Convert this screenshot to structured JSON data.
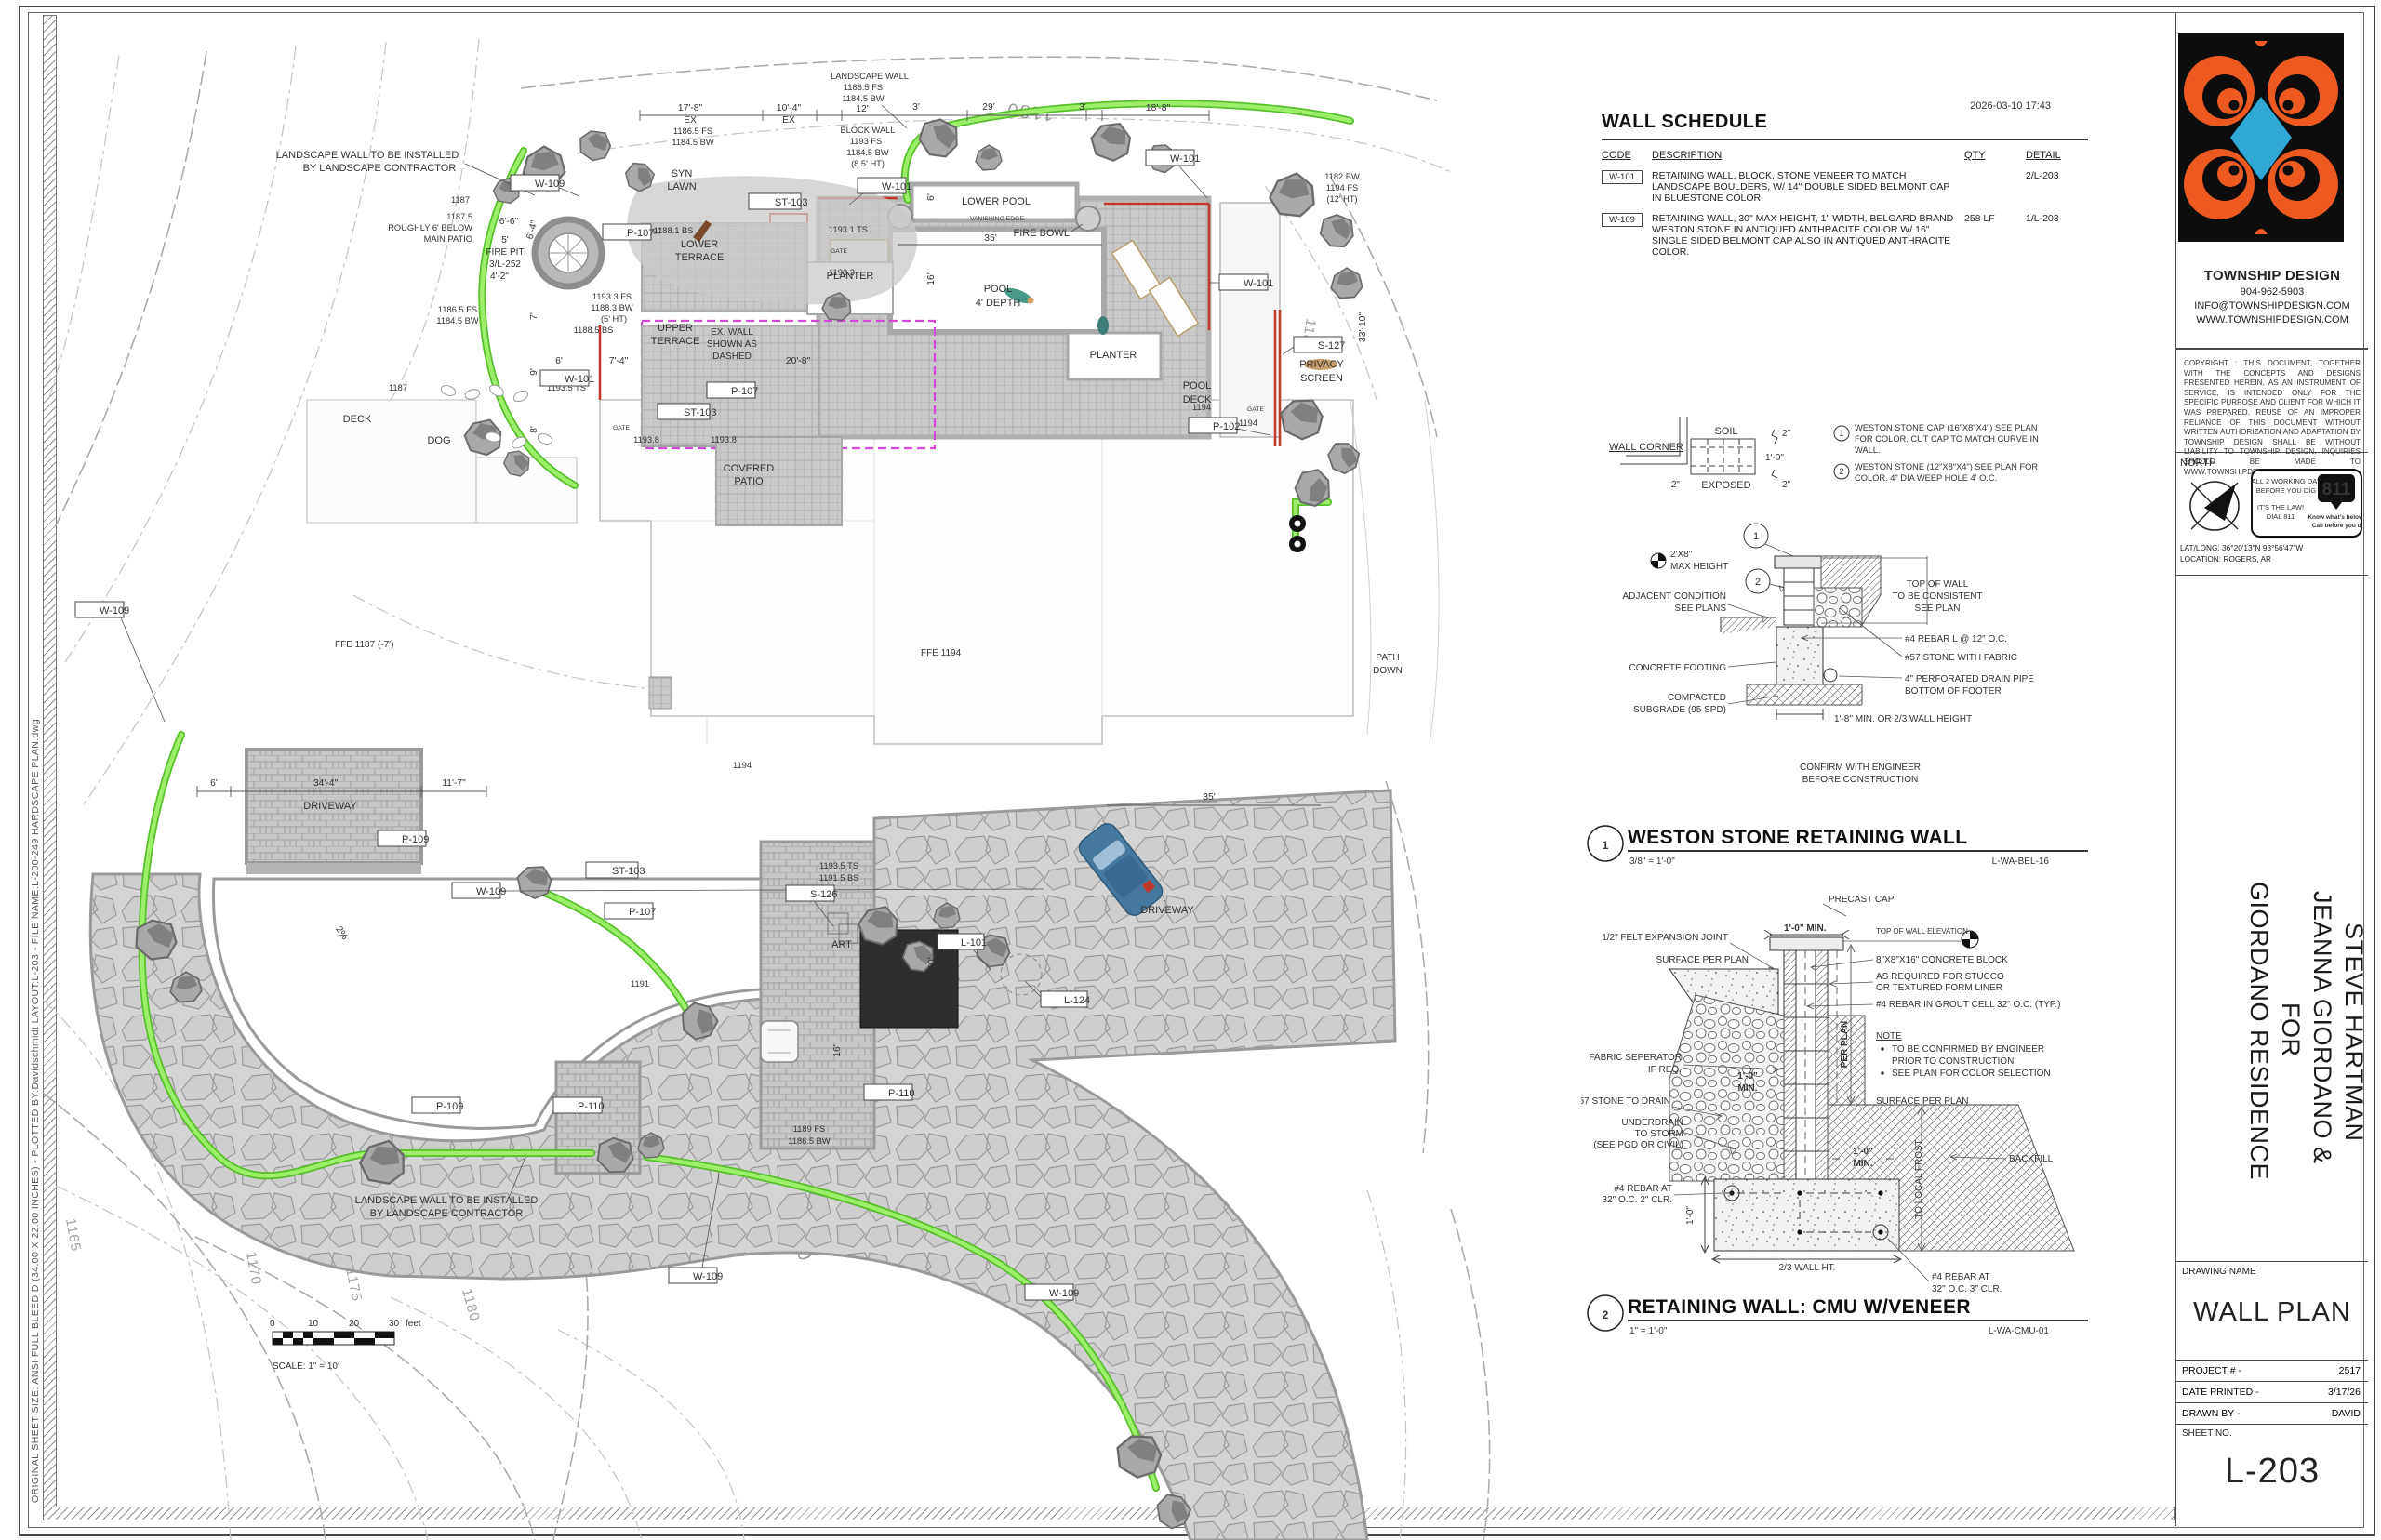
{
  "sheet": {
    "timestamp": "2026-03-10 17:43",
    "edge_text": "ORIGINAL SHEET SIZE: ANSI FULL BLEED D (34.00 X 22.00 INCHES) - PLOTTED BY:Davidschmidt  LAYOUT:L-203 - FILE NAME:L-200-249 HARDSCAPE PLAN.dwg"
  },
  "schedule": {
    "title": "WALL SCHEDULE",
    "col_code": "CODE",
    "col_desc": "DESCRIPTION",
    "col_qty": "QTY",
    "col_detail": "DETAIL",
    "rows": [
      {
        "code": "W-101",
        "desc": "RETAINING WALL, BLOCK, STONE VENEER TO MATCH LANDSCAPE BOULDERS, W/ 14\" DOUBLE SIDED  BELMONT CAP IN BLUESTONE COLOR.",
        "qty": "",
        "detail": "2/L-203"
      },
      {
        "code": "W-109",
        "desc": "RETAINING WALL, 30\" MAX HEIGHT, 1\" WIDTH, BELGARD BRAND WESTON STONE IN ANTIQUED ANTHRACITE COLOR W/ 16\" SINGLE SIDED BELMONT CAP ALSO IN ANTIQUED ANTHRACITE COLOR.",
        "qty": "258 LF",
        "detail": "1/L-203"
      }
    ]
  },
  "corner": {
    "title": "WALL CORNER",
    "soil": "SOIL",
    "exposed": "EXPOSED",
    "d_top": "2\"",
    "d_mid": "1'-0\"",
    "d_bot": "2\"",
    "d_left": "2\"",
    "n1": "1",
    "n1a": "WESTON STONE CAP (16\"X8\"X4\") SEE PLAN",
    "n1b": "FOR COLOR. CUT CAP TO MATCH CURVE IN",
    "n1c": "WALL.",
    "n2": "2",
    "n2a": "WESTON STONE (12\"X8\"X4\") SEE PLAN FOR",
    "n2b": "COLOR. 4\" DIA WEEP HOLE 4' O.C."
  },
  "detail1": {
    "num": "1",
    "title": "WESTON STONE RETAINING WALL",
    "scale": "3/8\" = 1'-0\"",
    "ref": "L-WA-BEL-16",
    "maxh1": "2'X8\"",
    "maxh2": "MAX HEIGHT",
    "adj1": "ADJACENT CONDITION",
    "adj2": "SEE PLANS",
    "footing": "CONCRETE FOOTING",
    "sub1": "COMPACTED",
    "sub2": "SUBGRADE (95 SPD)",
    "top1": "TOP OF WALL",
    "top2": "TO BE CONSISTENT",
    "top3": "SEE PLAN",
    "rebar": "#4 REBAR L @ 12\" O.C.",
    "stone": "#57 STONE WITH FABRIC",
    "pipe1": "4\" PERFORATED DRAIN PIPE",
    "pipe2": "BOTTOM OF FOOTER",
    "min": "1'-8\" MIN. OR 2/3 WALL HEIGHT",
    "conf1": "CONFIRM WITH ENGINEER",
    "conf2": "BEFORE CONSTRUCTION",
    "c1": "1",
    "c2": "2"
  },
  "detail2": {
    "num": "2",
    "title": "RETAINING WALL: CMU W/VENEER",
    "scale": "1\" = 1'-0\"",
    "ref": "L-WA-CMU-01",
    "cap": "PRECAST CAP",
    "min1": "1'-0\" MIN.",
    "towe": "TOP OF WALL ELEVATION",
    "felt": "1/2\" FELT EXPANSION JOINT",
    "surf1": "SURFACE PER PLAN",
    "block": "8\"X8\"X16\" CONCRETE BLOCK",
    "stucco1": "AS REQUIRED FOR STUCCO",
    "stucco2": "OR TEXTURED FORM LINER",
    "rebar": "#4 REBAR IN GROUT CELL 32\" O.C. (TYP.)",
    "perplan": "PER PLAN",
    "note": "NOTE",
    "note1a": "TO BE CONFIRMED BY ENGINEER",
    "note1b": "PRIOR TO CONSTRUCTION",
    "note2": "SEE PLAN FOR COLOR SELECTION",
    "fabric1": "FABRIC SEPERATOR",
    "fabric2": "IF REQ.",
    "min2a": "1'-0\"",
    "min2b": "MIN.",
    "drain": "#57 STONE TO DRAIN",
    "und1": "UNDERDRAIN",
    "und2": "TO STORM",
    "und3": "(SEE PGD OR CIVIL)",
    "surf2": "SURFACE PER PLAN",
    "min3a": "1'-0\"",
    "min3b": "MIN.",
    "frost": "TO LOCAL FROST",
    "backfill": "BACKFILL",
    "reb2a": "#4 REBAR AT",
    "reb2b": "32\" O.C. 2\" CLR.",
    "dim1": "1'-0\"",
    "wallht": "2/3 WALL HT.",
    "reb3a": "#4 REBAR AT",
    "reb3b": "32\" O.C. 3\" CLR."
  },
  "titleblock": {
    "company": "TOWNSHIP DESIGN",
    "phone": "904-962-5903",
    "email": "INFO@TOWNSHIPDESIGN.COM",
    "website": "WWW.TOWNSHIPDESIGN.COM",
    "copyright": "COPYRIGHT : THIS DOCUMENT, TOGETHER WITH THE CONCEPTS AND DESIGNS PRESENTED HEREIN, AS AN INSTRUMENT OF SERVICE, IS INTENDED ONLY FOR THE SPECIFIC PURPOSE AND CLIENT FOR WHICH IT WAS PREPARED. REUSE OF AN IMPROPER RELIANCE OF THIS DOCUMENT WITHOUT WRITTEN AUTHORIZATION AND ADAPTATION BY TOWNSHIP DESIGN SHALL BE WITHOUT LIABILITY TO TOWNSHIP DESIGN. INQUIRIES SHOULD BE MADE TO WWW.TOWNSHIPDESIGN.COM",
    "north": "NORTH",
    "call1": "CALL 2 WORKING DAYS",
    "call2": "BEFORE YOU DIG",
    "call3": "IT'S THE LAW!",
    "call4": "DIAL 811",
    "call811": "811",
    "know1": "Know what's below.",
    "know2": "Call before you dig.",
    "latlong": "LAT/LONG: 36°20'13\"N 93°56'47\"W",
    "location": "LOCATION: ROGERS, AR",
    "client1": "GIORDANO RESIDENCE",
    "client2": "FOR",
    "client3": "JEANNA GIORDANO &",
    "client4": "STEVE HARTMAN",
    "dn_label": "DRAWING NAME",
    "dn": "WALL PLAN",
    "proj_label": "PROJECT # -",
    "proj": "2517",
    "date_label": "DATE PRINTED -",
    "date": "3/17/26",
    "drawn_label": "DRAWN BY -",
    "drawn": "DAVID",
    "sheet_label": "SHEET NO.",
    "sheet": "L-203"
  },
  "plan": {
    "l": {
      "lw1": "LANDSCAPE WALL TO BE INSTALLED",
      "lw2": "BY LANDSCAPE CONTRACTOR",
      "syn1": "SYN",
      "syn2": "LAWN",
      "lower": "LOWER",
      "upper": "UPPER",
      "terrace": "TERRACE",
      "planter": "PLANTER",
      "pdp1": "POOL DECK",
      "pdp2": "(PAVERS)",
      "cov1": "COVERED",
      "cov2": "PATIO",
      "lowerpool": "LOWER POOL",
      "vanish": "VANISHING EDGE",
      "firebowl": "FIRE BOWL",
      "pool1": "POOL",
      "pool2": "4' DEPTH",
      "deck": "DECK",
      "dog": "DOG",
      "art": "ART",
      "privacy1": "PRIVACY",
      "privacy2": "SCREEN",
      "driveway": "DRIVEWAY",
      "path1": "PATH",
      "path2": "DOWN",
      "fp1": "5'",
      "fp2": "FIRE PIT",
      "fp3": "3/L-252",
      "fp4": "4'-2\"",
      "ex1": "EX. WALL",
      "ex2": "SHOWN AS",
      "ex3": "DASHED",
      "gate": "GATE",
      "ex": "EX",
      "ffe1": "FFE 1187 (-7')",
      "ffe2": "FFE 1194"
    },
    "tags": {
      "w101": "W-101",
      "w109": "W-109",
      "p107": "P-107",
      "p109": "P-109",
      "p110": "P-110",
      "st103": "ST-103",
      "s126": "S-126",
      "s127": "S-127",
      "p102": "P-102",
      "l101": "L-101",
      "l124": "L-124"
    },
    "dims": {
      "d6": "6'",
      "d7": "7'",
      "d8": "8'",
      "d9": "9'",
      "d10": "10'",
      "d12": "12'",
      "d3": "3'",
      "d16": "16'",
      "d29": "29'",
      "d35": "35'",
      "d17_8": "17'-8\"",
      "d10_4": "10'-4\"",
      "d18_8": "18'-8\"",
      "d33_10": "33'-10\"",
      "d20_8": "20'-8\"",
      "d7_4": "7'-4\"",
      "d6_6": "6'-6\"",
      "d6_4": "6'-4\"",
      "d34_4": "34'-4\"",
      "d11_7": "11'-7\"",
      "d2pct": "2%"
    },
    "elev": {
      "lwall": "LANDSCAPE WALL",
      "bwall": "BLOCK WALL",
      "fs11865": "1186.5 FS",
      "bw11845": "1184.5 BW",
      "fs1193": "1193 FS",
      "ht85": "(8.5' HT)",
      "bw1182": "1182 BW",
      "fs1194": "1194 FS",
      "ht12": "(12' HT)",
      "fs11933": "1193.3 FS",
      "bw11883": "1188.3 BW",
      "ht5": "(5' HT)",
      "bs11885": "1188.5 BS",
      "bs11881": "1188.1 BS",
      "ts11931": "1193.1 TS",
      "v11933": "1193.3",
      "ts11935": "1193.5 TS",
      "bs11915": "1191.5 BS",
      "v11938": "1193.8",
      "v1194": "1194",
      "v1191": "1191",
      "fs1189": "1189 FS",
      "bw11865": "1186.5 BW",
      "v1187": "1187",
      "v11875": "1187.5",
      "rough1": "ROUGHLY 6' BELOW",
      "rough2": "MAIN PATIO"
    },
    "contours": {
      "c1165": "1165",
      "c1170": "1170",
      "c1175": "1175",
      "c1180": "1180",
      "c1185": "1185",
      "c1190": "1190"
    },
    "scale": {
      "t0": "0",
      "t10": "10",
      "t20": "20",
      "t30": "30",
      "unit": "feet",
      "label": "SCALE: 1\" = 10'"
    }
  },
  "colors": {
    "accent_green": "#57c02b",
    "wall_red": "#c13a2e",
    "ex_magenta": "#d348d8",
    "logo_orange": "#ec5a22",
    "logo_blue": "#2fa8d5"
  }
}
